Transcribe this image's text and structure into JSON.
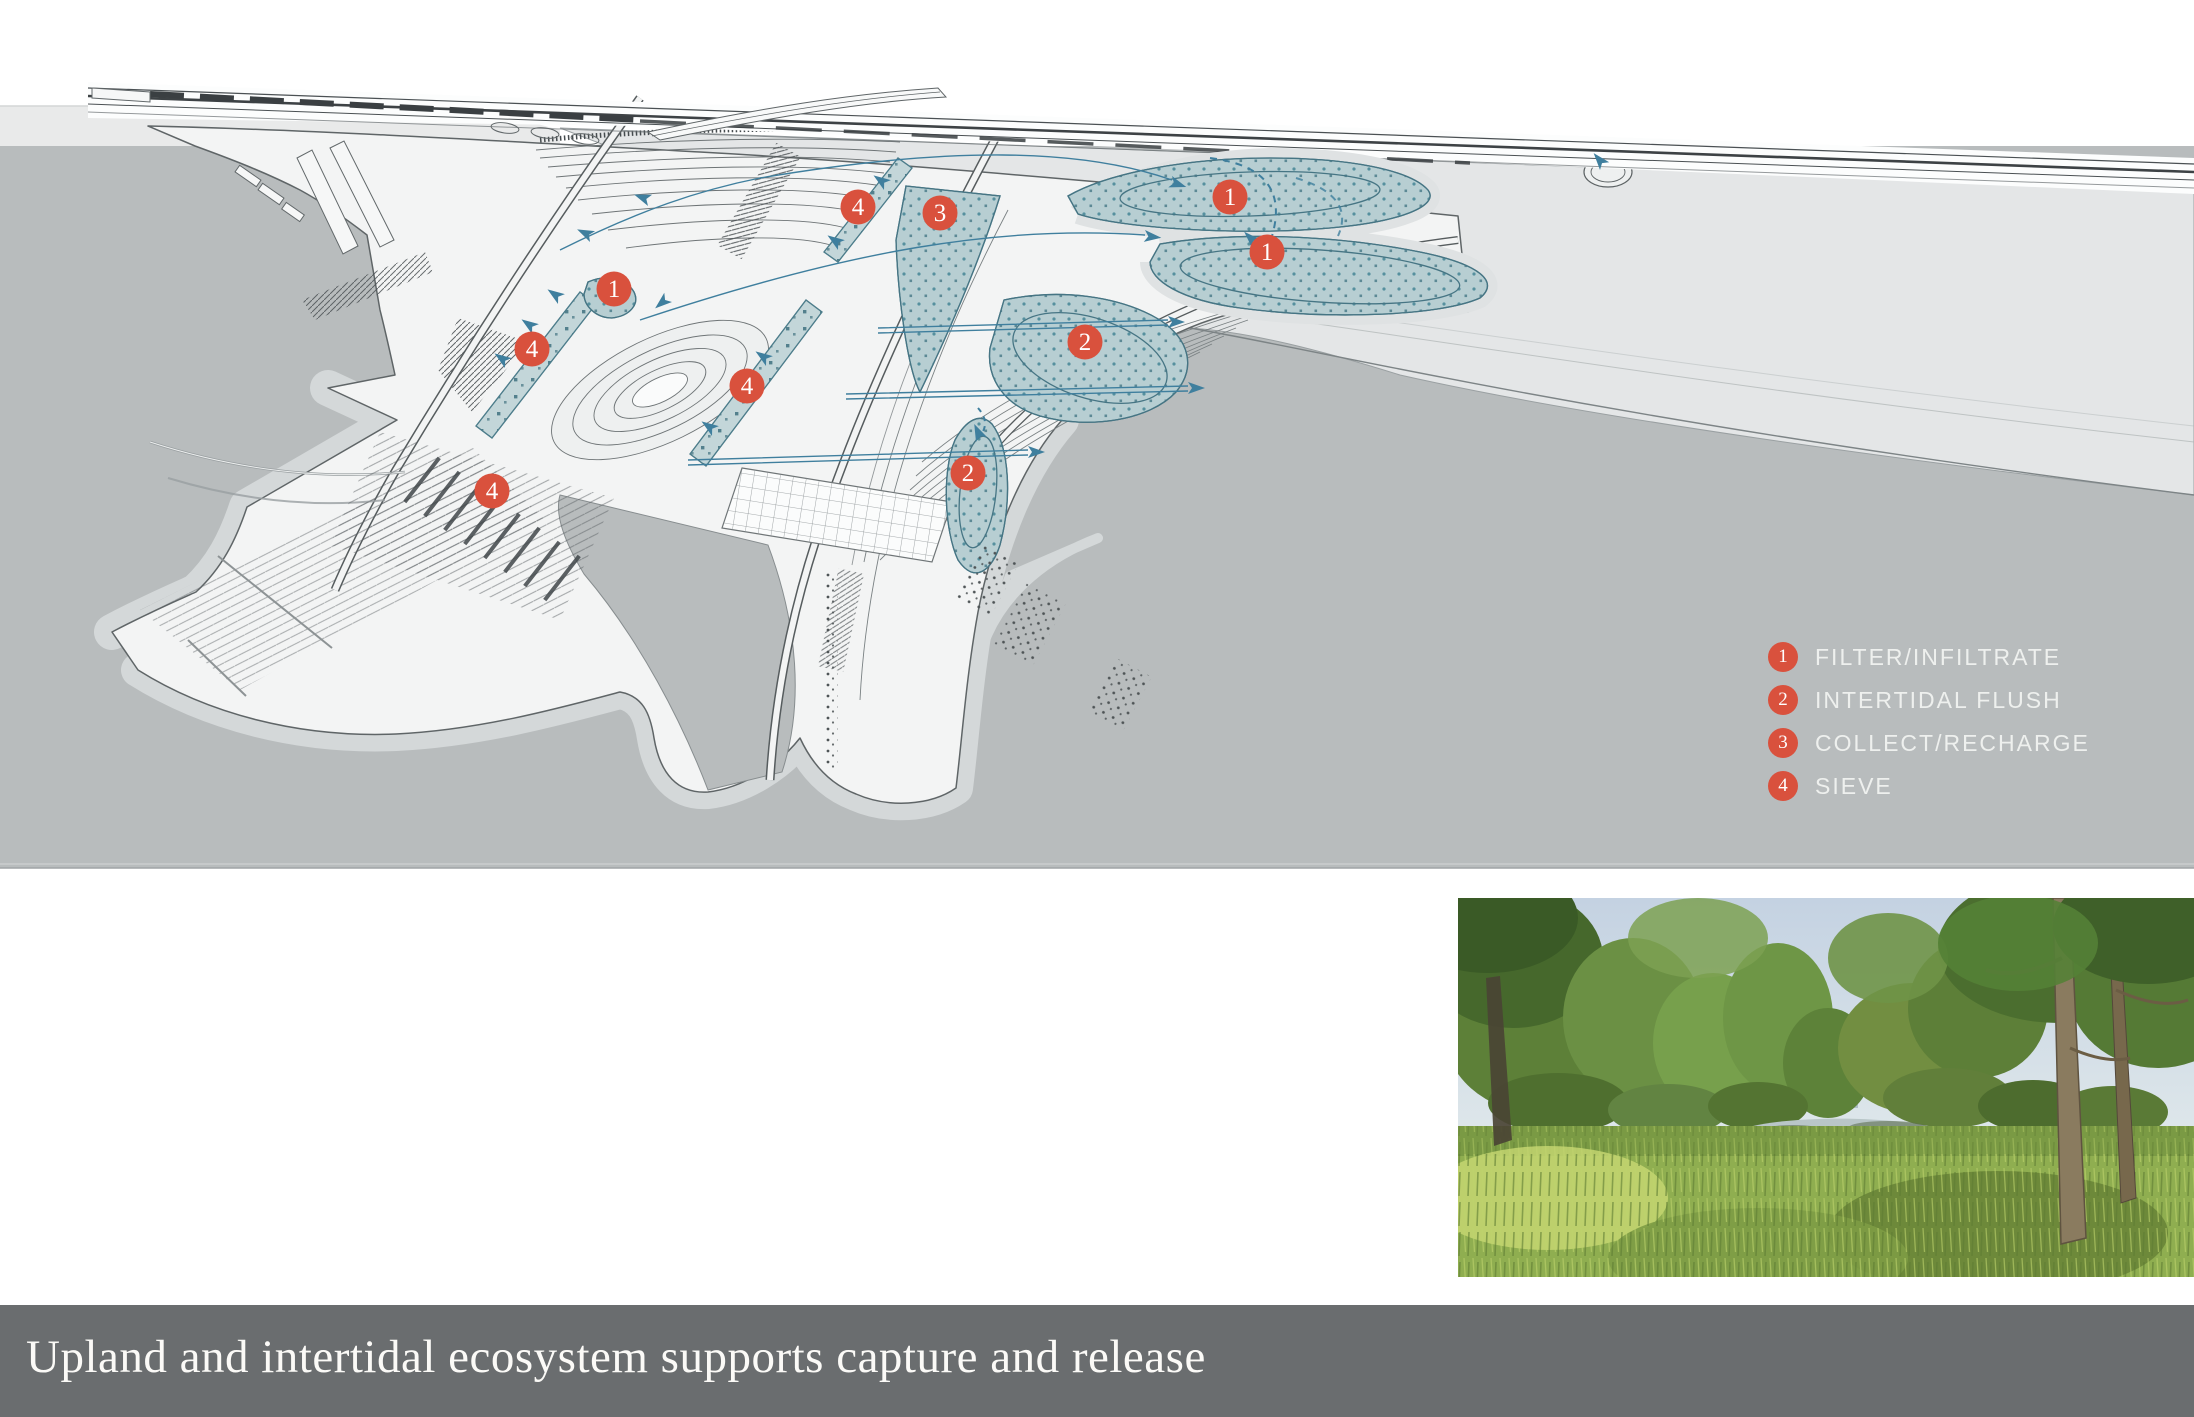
{
  "diagram": {
    "title": "axonometric watershed strategy plan",
    "legend": {
      "items": [
        {
          "number": "1",
          "label": "FILTER/INFILTRATE"
        },
        {
          "number": "2",
          "label": "INTERTIDAL FLUSH"
        },
        {
          "number": "3",
          "label": "COLLECT/RECHARGE"
        },
        {
          "number": "4",
          "label": "SIEVE"
        }
      ]
    },
    "markers": [
      {
        "number": "4",
        "x": 858,
        "y": 207
      },
      {
        "number": "3",
        "x": 940,
        "y": 213
      },
      {
        "number": "1",
        "x": 1230,
        "y": 197
      },
      {
        "number": "1",
        "x": 1267,
        "y": 252
      },
      {
        "number": "2",
        "x": 1085,
        "y": 342
      },
      {
        "number": "1",
        "x": 614,
        "y": 289
      },
      {
        "number": "4",
        "x": 532,
        "y": 349
      },
      {
        "number": "4",
        "x": 747,
        "y": 386
      },
      {
        "number": "2",
        "x": 968,
        "y": 473
      },
      {
        "number": "4",
        "x": 492,
        "y": 491
      }
    ],
    "colors": {
      "marker_red": "#d9513d",
      "flow_blue": "#3f7f9e",
      "wetland_teal": "#b7ced2",
      "water_gray": "#b8bcbd",
      "caption_bar": "#6a6d6f"
    }
  },
  "photo": {
    "subject": "wetland stream bordered by tall grasses and trees"
  },
  "caption": {
    "text": "Upland and intertidal ecosystem supports capture and release"
  }
}
